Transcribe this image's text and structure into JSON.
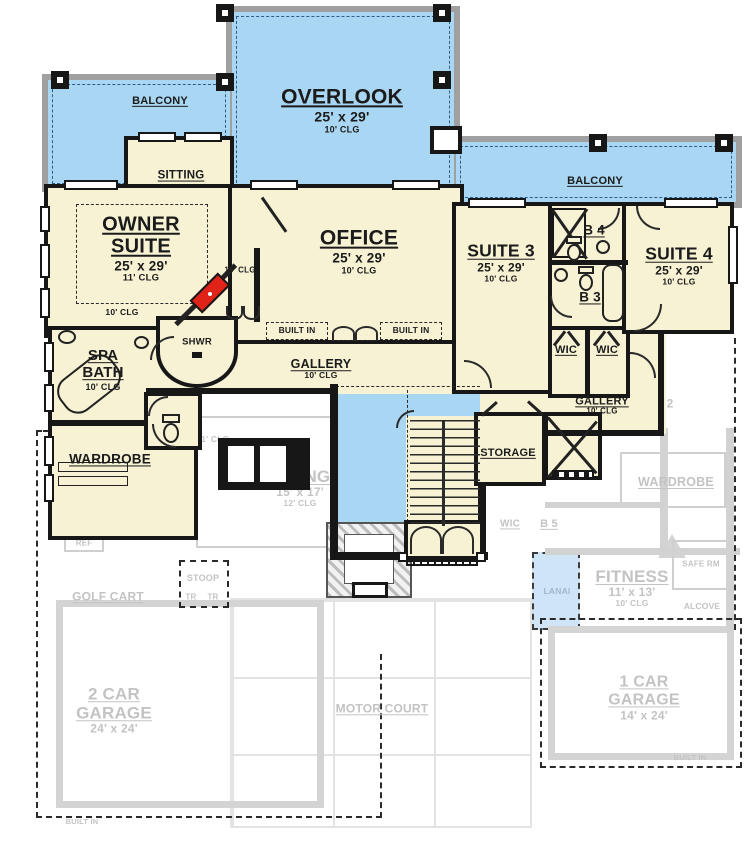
{
  "f2": {
    "balcony_left": {
      "label": "BALCONY"
    },
    "overlook": {
      "label": "OVERLOOK",
      "dims": "25' x 29'",
      "clg": "10' CLG"
    },
    "balcony_right": {
      "label": "BALCONY"
    },
    "sitting": {
      "label": "SITTING"
    },
    "owner": {
      "label": "OWNER SUITE",
      "dims": "25' x 29'",
      "clg": "11' CLG",
      "clg_entry": "10' CLG"
    },
    "vestibule": {
      "clg": "10' CLG"
    },
    "office": {
      "label": "OFFICE",
      "dims": "25' x 29'",
      "clg": "10' CLG"
    },
    "built_in_left": "BUILT IN",
    "built_in_right": "BUILT IN",
    "gallery": {
      "label": "GALLERY",
      "clg": "10' CLG"
    },
    "gallery_right": {
      "label": "GALLERY",
      "clg": "10' CLG"
    },
    "spa_bath": {
      "label": "SPA BATH",
      "clg": "10' CLG"
    },
    "shower": {
      "label": "SHWR"
    },
    "wardrobe": {
      "label": "WARDROBE"
    },
    "suite3": {
      "label": "SUITE 3",
      "dims": "25' x 29'",
      "clg": "10' CLG"
    },
    "suite4": {
      "label": "SUITE 4",
      "dims": "25' x 29'",
      "clg": "10' CLG"
    },
    "b4": {
      "label": "B 4"
    },
    "b3": {
      "label": "B 3"
    },
    "wic_a": {
      "label": "WIC"
    },
    "wic_b": {
      "label": "WIC"
    },
    "storage": {
      "label": "STORAGE"
    }
  },
  "f1": {
    "clg_11": "11' CLG",
    "dining": {
      "label": "DINING",
      "dims": "15' x 17'",
      "clg": "12' CLG"
    },
    "ref": "REF",
    "stoop": "STOOP",
    "tr_a": "TR",
    "tr_b": "TR",
    "golf_cart": "GOLF CART",
    "garage2": {
      "label": "2 CAR GARAGE",
      "dims": "24' x 24'"
    },
    "motor_court": "MOTOR COURT",
    "garage1": {
      "label": "1 CAR GARAGE",
      "dims": "14' x 24'"
    },
    "built_in_a": "BUILT IN",
    "built_in_b": "BUILT IN",
    "wic": "WIC",
    "b5": "B 5",
    "wardrobe": "WARDROBE",
    "fitness": {
      "label": "FITNESS",
      "dims": "11' x 13'",
      "clg": "10' CLG"
    },
    "safe_rm": "SAFE RM",
    "alcove": "ALCOVE",
    "lanai": "LANAI",
    "level_2": "2"
  },
  "colors": {
    "room_fill": "#f7f2d4",
    "balcony_fill": "#a9d6f2",
    "wall": "#171717",
    "ghost": "#c9c9c9",
    "fireplace_red": "#df2318",
    "railing_gray": "#a0a0a0"
  }
}
